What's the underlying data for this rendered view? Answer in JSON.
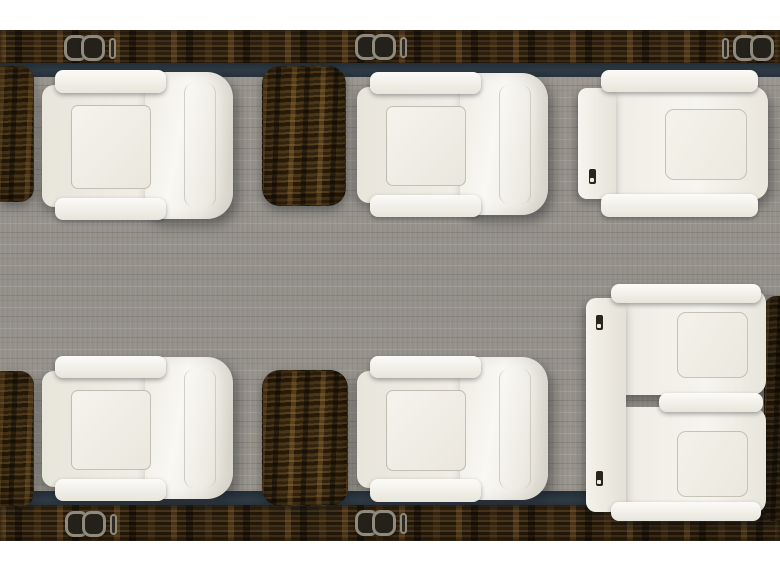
{
  "meta": {
    "title": "Private jet cabin seating layout - top-down view",
    "canvas": {
      "w": 780,
      "h": 574
    },
    "seat_count_visible": 8,
    "description": "Top view render of an executive aircraft cabin: four single club chairs facing forward-left, one lounge chair facing right, one two-place divan, wood side ledges with infinity-shaped inlays, wood cabinets, grey aisle carpet"
  },
  "palette": {
    "page_bg": "#ffffff",
    "wood_dark": "#271a08",
    "wood_mid": "#3a2a12",
    "wood_light": "#553f1f",
    "ledge_shadow": "#2e3a44",
    "carpet": "#97938b",
    "carpet_light": "#a8a49c",
    "carpet_dark": "#8b8780",
    "seat_white": "#f2efe8",
    "seat_shade": "#dcd8cd",
    "marker_ring": "#8f8a7c",
    "marker_fill": "#23211a"
  },
  "scene": {
    "elements": [
      {
        "name": "sidewall-ledge-top",
        "kind": "rail",
        "rect": {
          "x": 0,
          "y": 30,
          "w": 780,
          "h": 35
        }
      },
      {
        "name": "ledge-shadow-top",
        "kind": "ledge",
        "rect": {
          "x": 0,
          "y": 63,
          "w": 780,
          "h": 14
        }
      },
      {
        "name": "aisle-carpet",
        "kind": "carpet",
        "rect": {
          "x": 0,
          "y": 76,
          "w": 780,
          "h": 417
        }
      },
      {
        "name": "ledge-shadow-bottom",
        "kind": "ledge",
        "rect": {
          "x": 0,
          "y": 491,
          "w": 780,
          "h": 16
        }
      },
      {
        "name": "sidewall-ledge-bottom",
        "kind": "rail",
        "rect": {
          "x": 0,
          "y": 505,
          "w": 780,
          "h": 36
        }
      },
      {
        "name": "cabinet-forward-left",
        "kind": "cabinet",
        "variant": "edge-left",
        "rect": {
          "x": 0,
          "y": 66,
          "w": 34,
          "h": 136
        }
      },
      {
        "name": "cabinet-forward-center",
        "kind": "cabinet",
        "rect": {
          "x": 262,
          "y": 66,
          "w": 84,
          "h": 140
        }
      },
      {
        "name": "cabinet-aft-left",
        "kind": "cabinet",
        "variant": "edge-left",
        "rect": {
          "x": 0,
          "y": 371,
          "w": 34,
          "h": 136
        }
      },
      {
        "name": "cabinet-aft-center",
        "kind": "cabinet",
        "rect": {
          "x": 262,
          "y": 370,
          "w": 86,
          "h": 136
        }
      },
      {
        "name": "sidewall-panel-right",
        "kind": "panel",
        "rect": {
          "x": 764,
          "y": 296,
          "w": 16,
          "h": 226
        }
      },
      {
        "name": "club-seat-1",
        "kind": "seat-club",
        "rect": {
          "x": 42,
          "y": 70,
          "w": 191,
          "h": 152
        }
      },
      {
        "name": "club-seat-2",
        "kind": "seat-club",
        "rect": {
          "x": 357,
          "y": 72,
          "w": 191,
          "h": 146
        }
      },
      {
        "name": "club-seat-3",
        "kind": "seat-club",
        "rect": {
          "x": 42,
          "y": 356,
          "w": 191,
          "h": 146
        }
      },
      {
        "name": "club-seat-4",
        "kind": "seat-club",
        "rect": {
          "x": 357,
          "y": 356,
          "w": 191,
          "h": 147
        }
      },
      {
        "name": "lounge-seat",
        "kind": "seat-lounge",
        "rect": {
          "x": 578,
          "y": 68,
          "w": 190,
          "h": 150
        }
      },
      {
        "name": "divan-two-place",
        "kind": "divan",
        "rect": {
          "x": 586,
          "y": 284,
          "w": 182,
          "h": 237
        }
      },
      {
        "name": "ledge-marker-top-left",
        "kind": "marker",
        "rect": {
          "x": 64,
          "y": 34,
          "w": 60,
          "h": 28
        }
      },
      {
        "name": "ledge-marker-top-center",
        "kind": "marker",
        "rect": {
          "x": 355,
          "y": 33,
          "w": 60,
          "h": 28
        }
      },
      {
        "name": "ledge-marker-top-right",
        "kind": "marker",
        "variant": "pill-left",
        "rect": {
          "x": 710,
          "y": 34,
          "w": 64,
          "h": 28
        }
      },
      {
        "name": "ledge-marker-bottom-left",
        "kind": "marker",
        "rect": {
          "x": 65,
          "y": 510,
          "w": 60,
          "h": 28
        }
      },
      {
        "name": "ledge-marker-bottom-center",
        "kind": "marker",
        "rect": {
          "x": 355,
          "y": 509,
          "w": 60,
          "h": 28
        }
      }
    ]
  }
}
